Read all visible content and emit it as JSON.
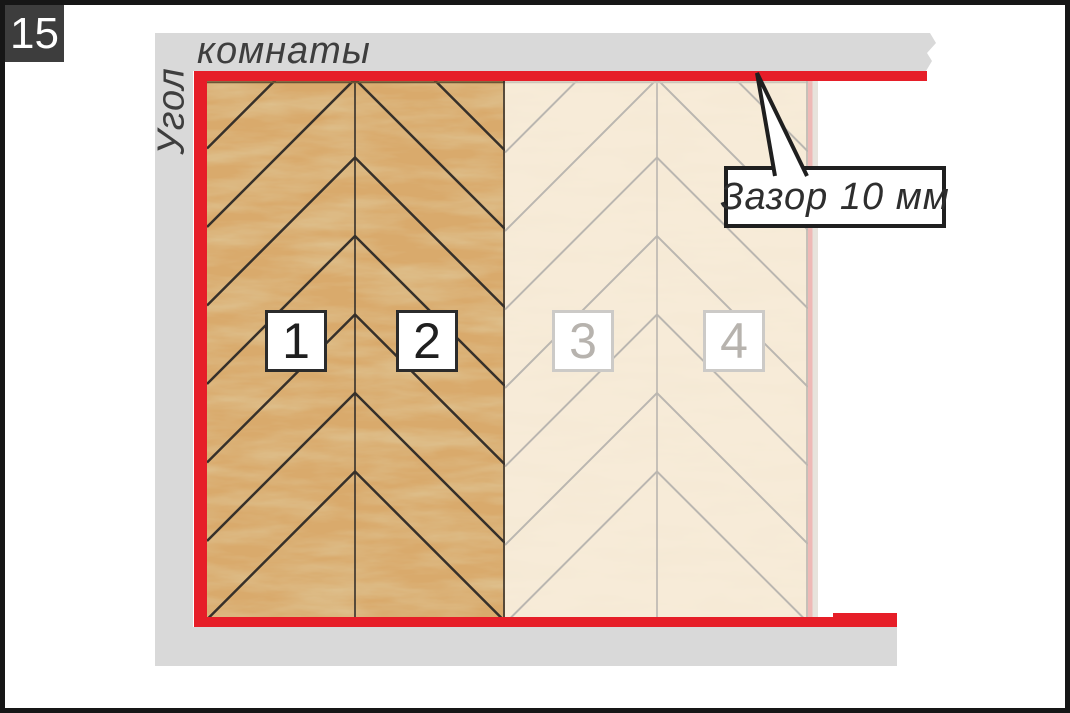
{
  "step_badge": {
    "number": "15"
  },
  "wall_labels": {
    "vertical": "Угол",
    "horizontal": "комнаты",
    "meaning": "corner of the room"
  },
  "callout": {
    "text": "Зазор 10 мм"
  },
  "plank_labels": [
    {
      "label": "1",
      "state": "installed"
    },
    {
      "label": "2",
      "state": "installed"
    },
    {
      "label": "3",
      "state": "planned"
    },
    {
      "label": "4",
      "state": "planned"
    }
  ],
  "colors": {
    "frame": "#161616",
    "badge_bg": "#3d3d3d",
    "badge_text": "#ffffff",
    "wall": "#d9d9d9",
    "wall_text": "#3e3e3e",
    "gap_red": "#e61e28",
    "wood_installed": "#d9aa6c",
    "wood_installed_line": "#36302a",
    "wood_planned": "#f7ebd8",
    "wood_planned_line": "#bab6b0",
    "label_installed_border": "#2b2b2b",
    "label_installed_text": "#1f1f1f",
    "label_planned_border": "#cccac7",
    "label_planned_text": "#b7b3ae",
    "callout_border": "#1f1f1f",
    "callout_text": "#2e2e2e",
    "planned_gap_pink": "#eeb9b6",
    "edge_sliver": "#e7e3dc"
  }
}
